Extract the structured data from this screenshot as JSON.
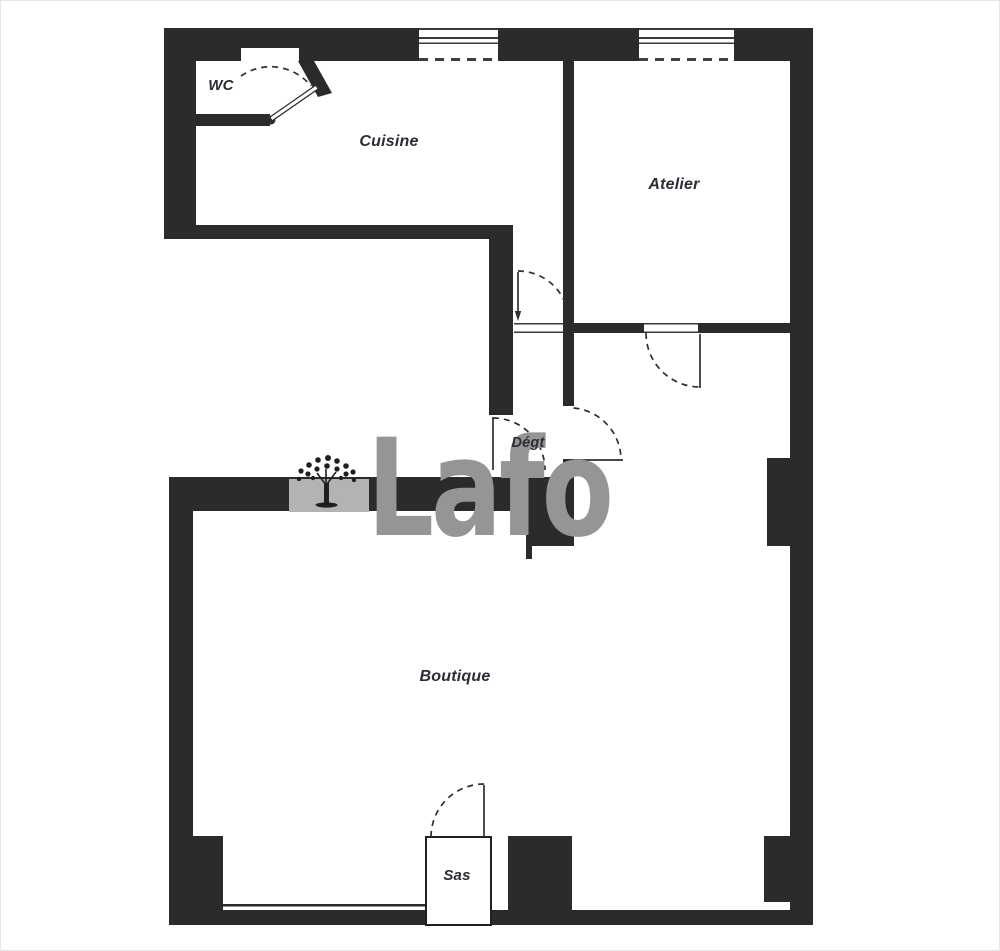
{
  "rooms": {
    "wc": {
      "label": "WC"
    },
    "cuisine": {
      "label": "Cuisine"
    },
    "atelier": {
      "label": "Atelier"
    },
    "degagement": {
      "label": "Dégt"
    },
    "boutique": {
      "label": "Boutique"
    },
    "sas": {
      "label": "Sas"
    }
  },
  "watermark": {
    "text": "Lafo",
    "tree_icon": "laforet-tree-logo"
  },
  "colors": {
    "wall": "#2b2b2b",
    "line": "#2f2f2f",
    "label": "#2c2c34",
    "watermark-gray": "#959595",
    "watermark-patch": "#b3b3b3",
    "watermark-tree": "#1f1f1f",
    "background": "#ffffff"
  }
}
